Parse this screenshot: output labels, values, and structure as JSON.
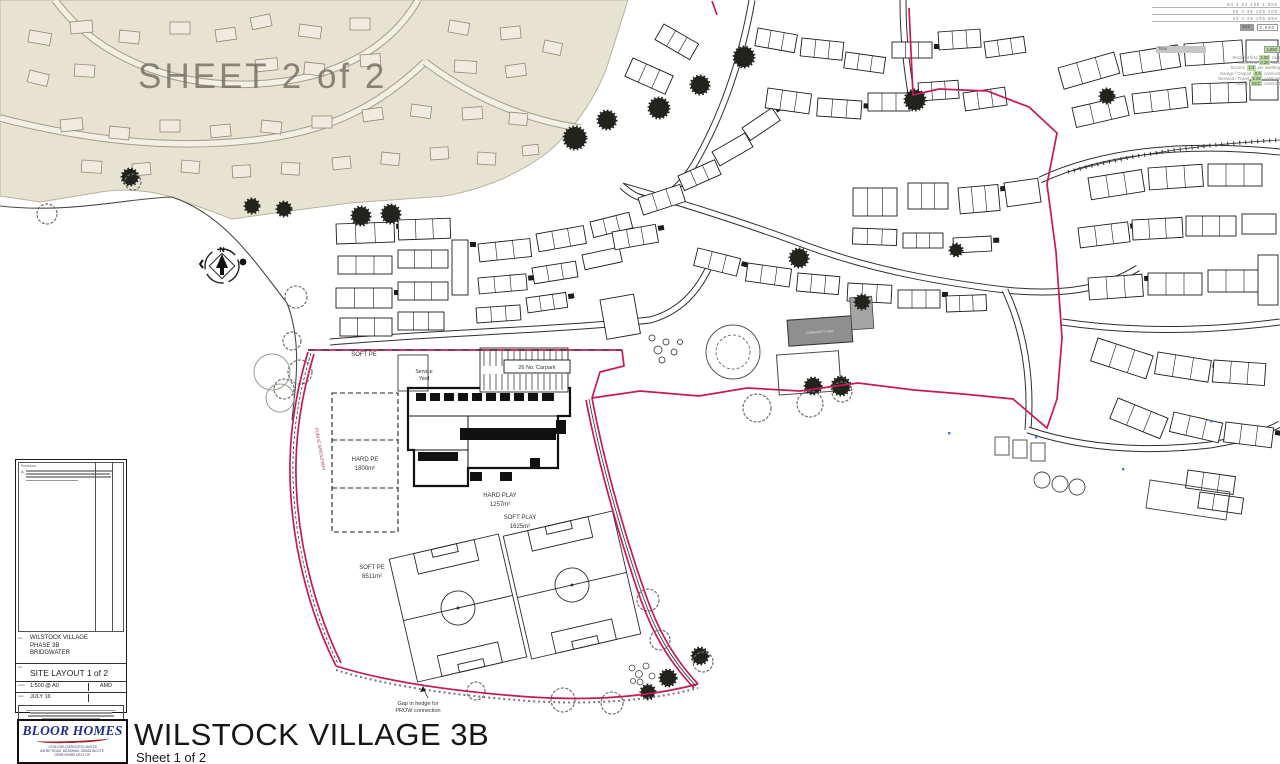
{
  "sheet_overlay": "SHEET 2 of 2",
  "compass": {
    "north": "N"
  },
  "labels": {
    "soft_pe_school": "SOFT PE",
    "service_line1": "Service",
    "service_line2": "Yard",
    "carpark": "26 No. Carpark",
    "hard_pe_line1": "HARD PE",
    "hard_pe_line2": "1800m²",
    "hard_play_line1": "HARD PLAY",
    "hard_play_line2": "1257m²",
    "soft_play_line1": "SOFT PLAY",
    "soft_play_line2": "1625m²",
    "soft_pe_field_line1": "SOFT PE",
    "soft_pe_field_line2": "8511m²",
    "gap_line1": "Gap in hedge for",
    "gap_line2": "PROW connection",
    "bridleway": "PUBLIC BRIDLEWAY",
    "community_hall": "COMMUNITY HALL"
  },
  "title_block": {
    "revisions_label": "Revisions",
    "revision_marker": "A",
    "site_label": "site",
    "site_line1": "WILSTOCK VILLAGE",
    "site_line2": "PHASE 3B",
    "site_line3": "BRIDGWATER",
    "title_label": "title",
    "drawing_title": "SITE LAYOUT 1 of 2",
    "scale_label": "scale",
    "scale_value": "1:500 @ A0",
    "status_value": "AMD",
    "date_label": "date",
    "date_value": "JULY 16"
  },
  "footer": {
    "logo_text": "BLOOR HOMES",
    "logo_addr1": "J S BLOOR (SERVICES) LIMITED",
    "logo_addr2": "ASHBY ROAD, MEASHAM, SWADLINCOTE,",
    "logo_addr3": "DERBYSHIRE DE12 7JP",
    "sheet_title": "WILSTOCK VILLAGE 3B",
    "sheet_subtitle": "Sheet 1 of 2"
  },
  "schedules": {
    "upper_rows": [
      "84 4 22 105 1,500",
      "56 4 25 105 400",
      "40 4 25 105 950"
    ],
    "upper_total_label": "tot",
    "upper_total_value": "2,850",
    "lower_header_label": "Total",
    "lower_header_value": "2,850",
    "lower_rows": [
      {
        "l": "Resident first",
        "v": "2.00",
        "u": "cars"
      },
      {
        "l": "Visitor first",
        "v": "0.25",
        "u": "cars"
      },
      {
        "l": "Second",
        "v": "1:4",
        "u": "per dwelling"
      },
      {
        "l": "Garage / Carport",
        "v": "0.5",
        "u": "cars/unit"
      },
      {
        "l": "Demand / Travel",
        "v": "2.25",
        "u": "cars/unit"
      },
      {
        "l": "Source",
        "v": "SCC",
        "u": "cars/unit"
      }
    ]
  },
  "colors": {
    "boundary_red": "#c6195a",
    "existing_area_beige": "#e7e3d1",
    "logo_blue": "#232d8c"
  }
}
